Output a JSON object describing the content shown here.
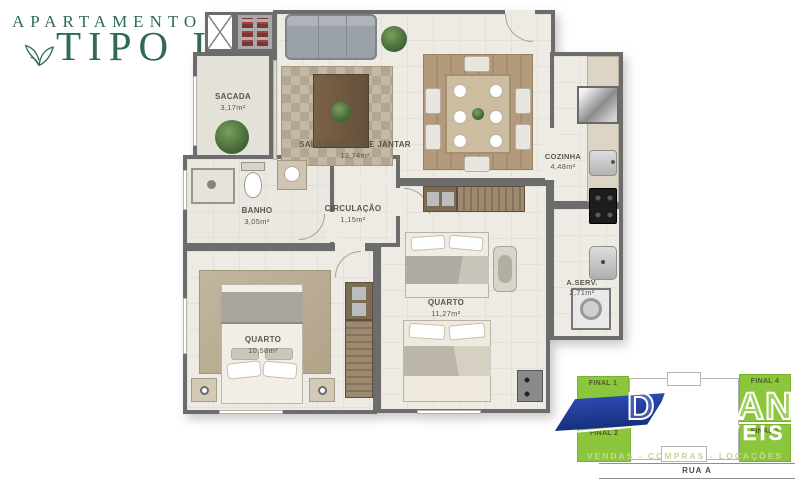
{
  "logo": {
    "line1": "APARTAMENTO",
    "line2": "TIPO I"
  },
  "plan": {
    "rooms": {
      "sacada": {
        "name": "SACADA",
        "area": "3,17m²"
      },
      "sala": {
        "name": "SALA DE ESTAR E JANTAR",
        "area": "13,74m²"
      },
      "cozinha": {
        "name": "COZINHA",
        "area": "4,48m²"
      },
      "banho": {
        "name": "BANHO",
        "area": "3,05m²"
      },
      "circulacao": {
        "name": "CIRCULAÇÃO",
        "area": "1,15m²"
      },
      "quarto1": {
        "name": "QUARTO",
        "area": "10,58m²"
      },
      "quarto2": {
        "name": "QUARTO",
        "area": "11,27m²"
      },
      "aserv": {
        "name": "A.SERV.",
        "area": "2,71m²"
      }
    }
  },
  "keyplan": {
    "unit_tl": "FINAL 1",
    "unit_tr": "FINAL 4",
    "unit_bl": "FINAL 2",
    "unit_br": "FINAL 3",
    "street": "RUA A"
  },
  "brand": {
    "name": "DARLAN",
    "type": "IMÓVEIS",
    "tagline": "VENDAS - COMPRAS - LOCAÇÕES"
  },
  "colors": {
    "logo_green": "#2e6b52",
    "keyplan_green": "#8cc63c",
    "brand_blue": "#1c348f",
    "wall_gray": "#6c6c6c",
    "floor": "#edebe4"
  }
}
